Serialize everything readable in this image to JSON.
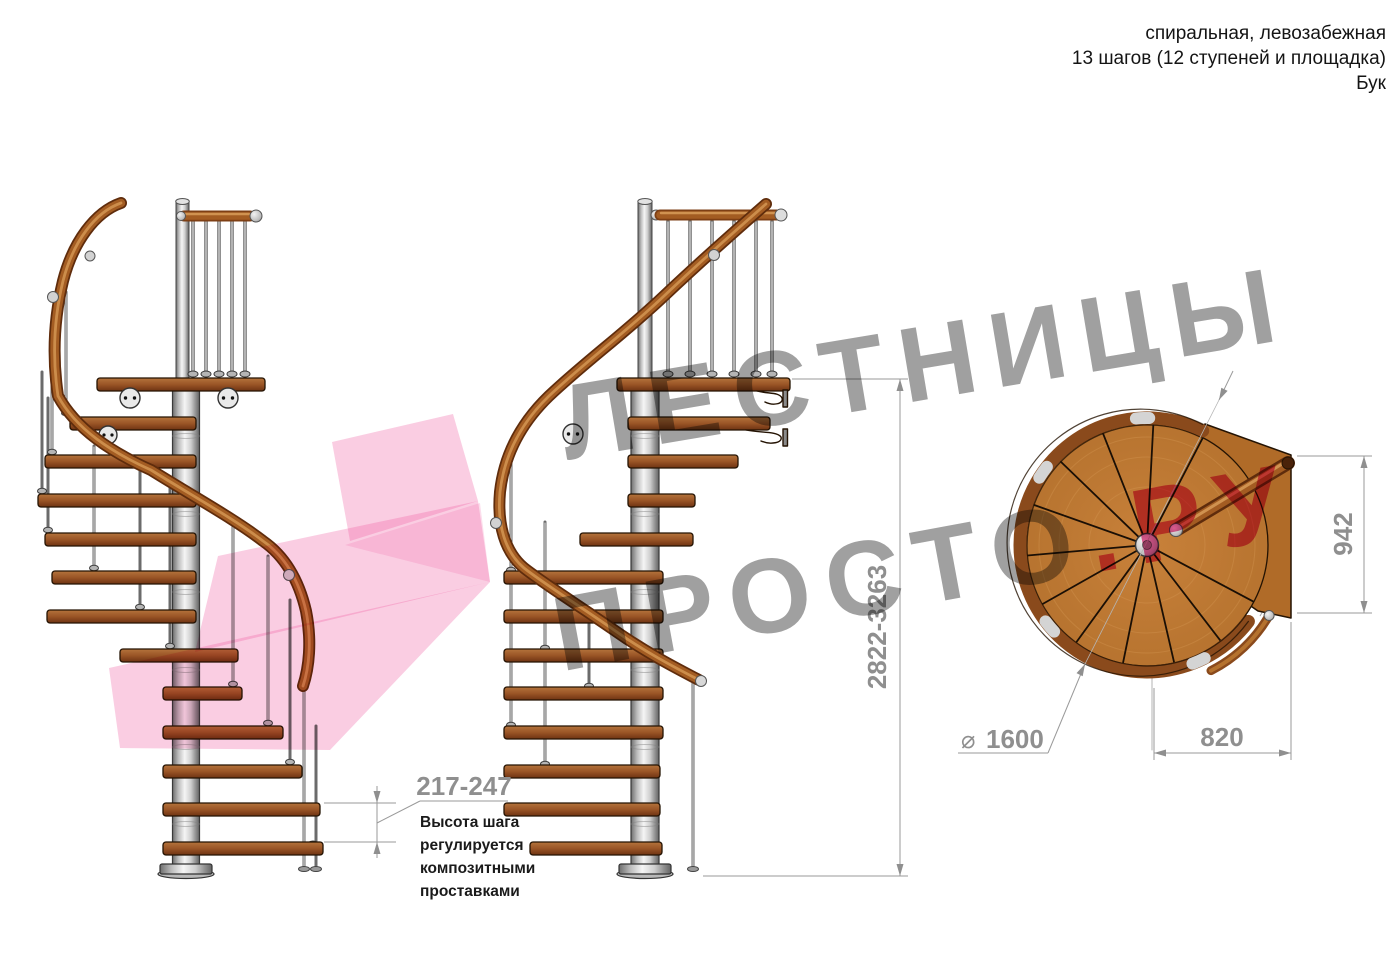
{
  "header": {
    "line1": "спиральная, левозабежная",
    "line2": "13 шагов (12 ступеней и площадка)",
    "line3": "Бук"
  },
  "watermark": {
    "line1": "ЛЕСТНИЦЫ",
    "line2_gray": "ПРОСТО",
    "line2_pink": ".РУ"
  },
  "dimensions": {
    "step_height": {
      "value": "217-247",
      "note_lines": [
        "Высота шага",
        "регулируется",
        "композитными",
        "проставками"
      ]
    },
    "total_height": {
      "value": "2822-3263"
    },
    "exit_width": {
      "value": "942"
    },
    "landing_depth": {
      "value": "820"
    },
    "diameter": {
      "symbol": "⌀",
      "value": "1600"
    }
  },
  "colors": {
    "watermark_gray": "#a0a0a0",
    "watermark_pink": "#e75f97",
    "arrow_pink": "#ee58a0",
    "wood": "#b5722e",
    "rail_brown": "#a35c22",
    "steel": "#c9c9c9",
    "dimension_gray": "#8f8f8f"
  }
}
